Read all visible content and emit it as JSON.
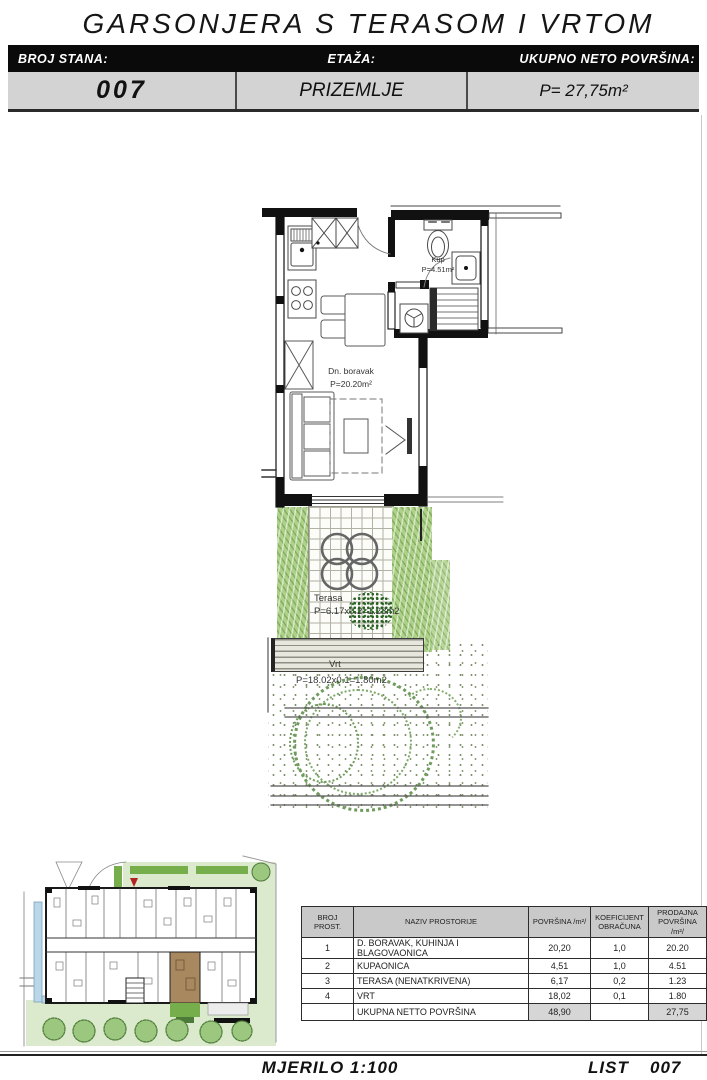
{
  "title": "GARSONJERA S TERASOM I VRTOM",
  "header": {
    "columns": [
      {
        "label": "BROJ STANA:",
        "value": "007"
      },
      {
        "label": "ETAŽA:",
        "value": "PRIZEMLJE"
      },
      {
        "label": "UKUPNO NETO POVRŠINA:",
        "value": "P= 27,75m²"
      }
    ]
  },
  "plan": {
    "living": {
      "name": "Dn. boravak",
      "area": "P=20.20m²"
    },
    "bathroom": {
      "name": "Kup",
      "area": "P=4.51m²"
    },
    "terrace": {
      "name": "Terasa",
      "area": "P=6.17x0.2=1.23m2"
    },
    "garden": {
      "name": "Vrt",
      "area": "P=18.02x0.1=1.80m2"
    }
  },
  "table": {
    "headers": [
      "BROJ PROST.",
      "NAZIV PROSTORIJE",
      "POVRŠINA /m²/",
      "KOEFICIJENT OBRAČUNA",
      "PRODAJNA POVRŠINA /m²/"
    ],
    "rows": [
      {
        "num": "1",
        "name": "D. BORAVAK, KUHINJA I BLAGOVAONICA",
        "area": "20,20",
        "coef": "1,0",
        "sale": "20.20"
      },
      {
        "num": "2",
        "name": "KUPAONICA",
        "area": "4,51",
        "coef": "1,0",
        "sale": "4.51"
      },
      {
        "num": "3",
        "name": "TERASA (NENATKRIVENA)",
        "area": "6,17",
        "coef": "0,2",
        "sale": "1.23"
      },
      {
        "num": "4",
        "name": "VRT",
        "area": "18,02",
        "coef": "0,1",
        "sale": "1.80"
      }
    ],
    "total": {
      "label": "UKUPNA NETTO POVRŠINA",
      "area": "48,90",
      "sale": "27,75"
    }
  },
  "footer": {
    "scale": "MJERILO  1:100",
    "list_label": "LIST",
    "sheet_no": "007"
  },
  "colors": {
    "wall": "#111111",
    "vegetation": "#aed188",
    "highlight_unit": "#a8885e",
    "pool": "#b9d7e9",
    "marker_red": "#b22222"
  }
}
